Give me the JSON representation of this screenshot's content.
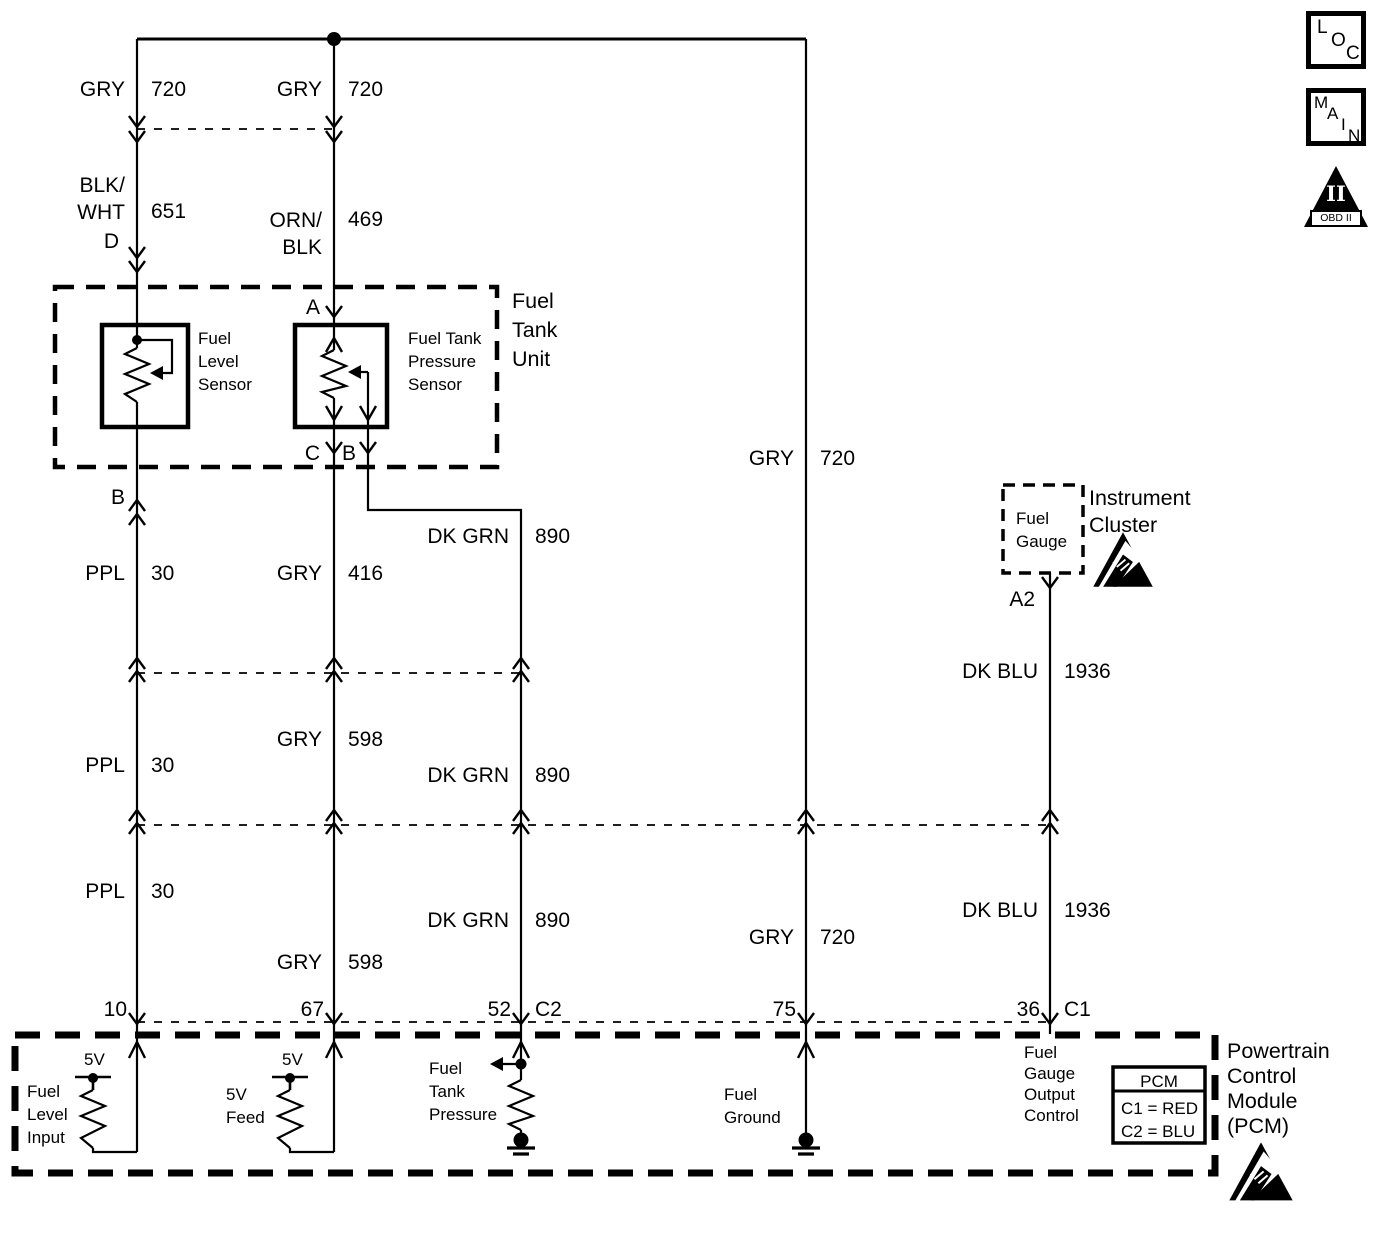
{
  "badges": {
    "loc": [
      "L",
      "O",
      "C"
    ],
    "main": [
      "M",
      "A",
      "I",
      "N"
    ],
    "obd_numeral": "II",
    "obd_label": "OBD II"
  },
  "colors": {
    "line": "#000000",
    "background": "#ffffff"
  },
  "fuel_tank_unit": {
    "label": "Fuel\nTank\nUnit",
    "level_sensor_label": "Fuel\nLevel\nSensor",
    "pressure_sensor_label": "Fuel Tank\nPressure\nSensor",
    "pins": {
      "d": "D",
      "a": "A",
      "c": "C",
      "b_pressure": "B",
      "b_level": "B"
    }
  },
  "instrument_cluster": {
    "label": "Instrument\nCluster",
    "fuel_gauge_label": "Fuel\nGauge",
    "pin_a2": "A2"
  },
  "pcm": {
    "label": "Powertrain\nControl\nModule\n(PCM)",
    "pins": {
      "p10": "10",
      "p67": "67",
      "p52": "52",
      "c2": "C2",
      "p75": "75",
      "p36": "36",
      "c1": "C1"
    },
    "functions": {
      "fuel_level_input": "Fuel\nLevel\nInput",
      "five_v_left": "5V",
      "five_v_feed": "5V\nFeed",
      "five_v_right": "5V",
      "fuel_tank_pressure": "Fuel\nTank\nPressure",
      "fuel_ground": "Fuel\nGround",
      "fuel_gauge_output_control": "Fuel\nGauge\nOutput\nControl"
    },
    "legend": {
      "title": "PCM",
      "c1": "C1 = RED",
      "c2": "C2 = BLU"
    }
  },
  "wire_labels": [
    {
      "color": "GRY",
      "circuit": "720"
    },
    {
      "color": "GRY",
      "circuit": "720"
    },
    {
      "color": "BLK/\nWHT",
      "circuit": "651"
    },
    {
      "color": "ORN/\nBLK",
      "circuit": "469"
    },
    {
      "color": "GRY",
      "circuit": "720"
    },
    {
      "color": "DK GRN",
      "circuit": "890"
    },
    {
      "color": "PPL",
      "circuit": "30"
    },
    {
      "color": "GRY",
      "circuit": "416"
    },
    {
      "color": "GRY",
      "circuit": "598"
    },
    {
      "color": "PPL",
      "circuit": "30"
    },
    {
      "color": "DK GRN",
      "circuit": "890"
    },
    {
      "color": "DK BLU",
      "circuit": "1936"
    },
    {
      "color": "PPL",
      "circuit": "30"
    },
    {
      "color": "DK GRN",
      "circuit": "890"
    },
    {
      "color": "GRY",
      "circuit": "598"
    },
    {
      "color": "GRY",
      "circuit": "720"
    },
    {
      "color": "DK BLU",
      "circuit": "1936"
    }
  ]
}
